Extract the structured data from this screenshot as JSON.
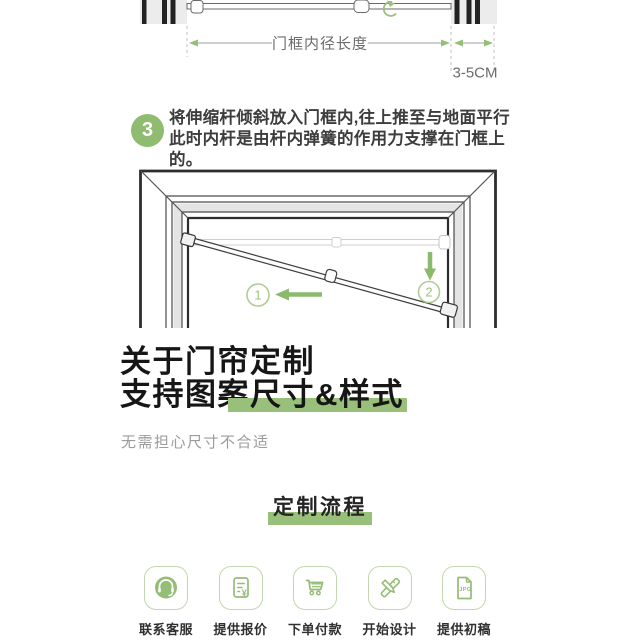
{
  "page": {
    "background": "#ffffff"
  },
  "colors": {
    "accent_green": "#8fbc70",
    "marker_green": "#98c07a",
    "icon_green": "#94bd76",
    "icon_border_green": "#c3d7ae",
    "text_dark": "#161616",
    "text_body": "#3d3d3d",
    "text_muted": "#9b9b9b",
    "dim_line_gray": "#9f9f9f"
  },
  "measure_diagram": {
    "span_label": "门框内径长度",
    "gap_label": "3-5CM"
  },
  "step3": {
    "number": "3",
    "line1": "将伸缩杆倾斜放入门框内,往上推至与地面平行",
    "line2": "此时内杆是由杆内弹簧的作用力支撑在门框上的。"
  },
  "install_diagram": {
    "marker1": "1",
    "marker2": "2"
  },
  "custom_section": {
    "title_line1": "关于门帘定制",
    "title_line2_prefix": "支持图案",
    "title_line2_highlight": "尺寸&样式",
    "subtitle": "无需担心尺寸不合适",
    "flow_title": "定制流程"
  },
  "flow_steps": [
    {
      "label": "联系客服",
      "icon": "customer-service-icon"
    },
    {
      "label": "提供报价",
      "icon": "quote-document-icon",
      "badge": "¥"
    },
    {
      "label": "下单付款",
      "icon": "shopping-cart-icon"
    },
    {
      "label": "开始设计",
      "icon": "design-tools-icon"
    },
    {
      "label": "提供初稿",
      "icon": "jpg-file-icon",
      "badge": "JPG"
    }
  ]
}
